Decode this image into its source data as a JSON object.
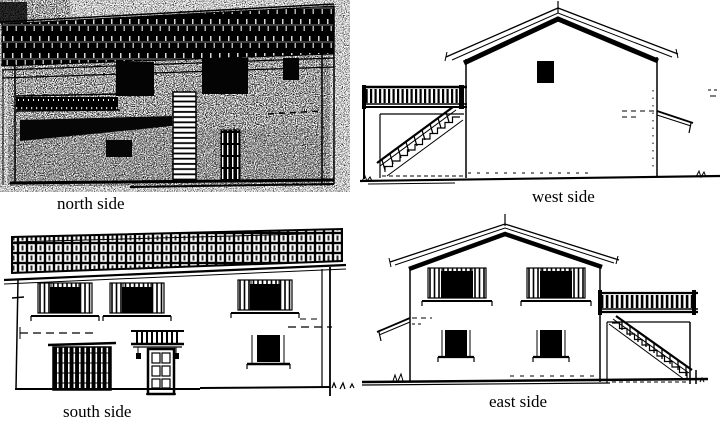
{
  "document": {
    "background_color": "#ffffff",
    "ink_color": "#000000"
  },
  "panels": [
    {
      "id": "north",
      "label": "north side"
    },
    {
      "id": "west",
      "label": "west side"
    },
    {
      "id": "south",
      "label": "south side"
    },
    {
      "id": "east",
      "label": "east side"
    }
  ]
}
